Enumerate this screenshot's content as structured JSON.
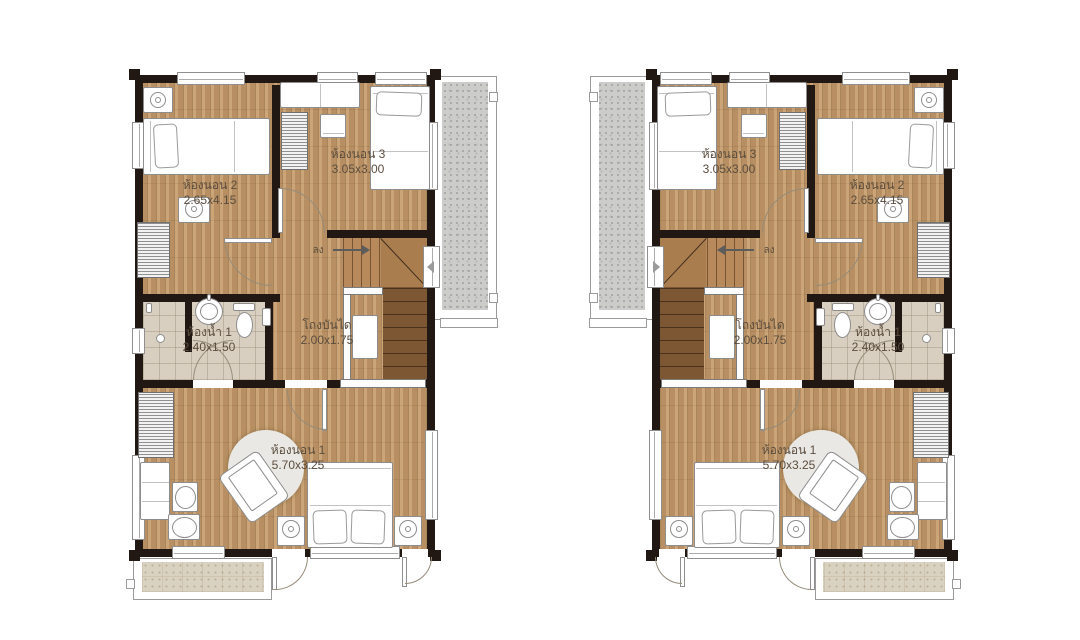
{
  "canvas": {
    "width": 1080,
    "height": 640,
    "background": "#ffffff"
  },
  "plans": [
    {
      "id": "left",
      "mirrored": false
    },
    {
      "id": "right",
      "mirrored": true
    }
  ],
  "rooms": {
    "bedroom2": {
      "label": "ห้องนอน 2",
      "dims": "2.65x4.15"
    },
    "bedroom3": {
      "label": "ห้องนอน 3",
      "dims": "3.05x3.00"
    },
    "bathroom1": {
      "label": "ห้องน้ำ 1",
      "dims": "2.40x1.50"
    },
    "stair_hall": {
      "label": "โถงบันได",
      "dims": "2.00x1.75"
    },
    "bedroom1": {
      "label": "ห้องนอน 1",
      "dims": "5.70x3.25"
    }
  },
  "stair_direction": {
    "label": "ลง"
  },
  "colors": {
    "wall": "#221813",
    "wood_floor": "#c59c6c",
    "tile_floor": "#d8cfc0",
    "terrace": "#cccccb",
    "balcony": "#dad2c1",
    "stair_upper": "#b8895a",
    "stair_lower": "#7d5634",
    "label_text": "#5b4d3e"
  }
}
